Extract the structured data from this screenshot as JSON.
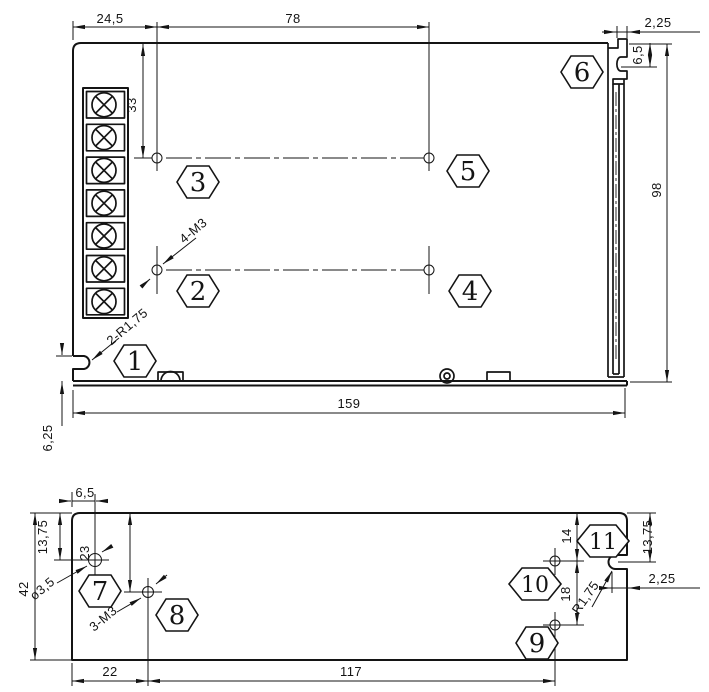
{
  "colors": {
    "ink": "#141414",
    "bg": "#ffffff"
  },
  "top_view": {
    "dims": {
      "w24_5": "24,5",
      "w78": "78",
      "w2_25": "2,25",
      "h6_5": "6,5",
      "h33": "33",
      "h98": "98",
      "w159": "159",
      "h6_25": "6,25"
    },
    "labels": {
      "thread_holes": "4-M3",
      "corner_slots": "2-R1,75"
    },
    "callouts": [
      "1",
      "2",
      "3",
      "4",
      "5",
      "6"
    ]
  },
  "bottom_view": {
    "dims": {
      "w6_5": "6,5",
      "h13_75_left": "13,75",
      "h23": "23",
      "h42": "42",
      "h14": "14",
      "h18": "18",
      "h13_75_right": "13,75",
      "w2_25": "2,25",
      "w22": "22",
      "w117": "117"
    },
    "labels": {
      "hole_diameter": "ø3,5",
      "thread_holes": "3-M3",
      "slot_radius": "R1,75"
    },
    "callouts": [
      "7",
      "8",
      "9",
      "10",
      "11"
    ]
  }
}
